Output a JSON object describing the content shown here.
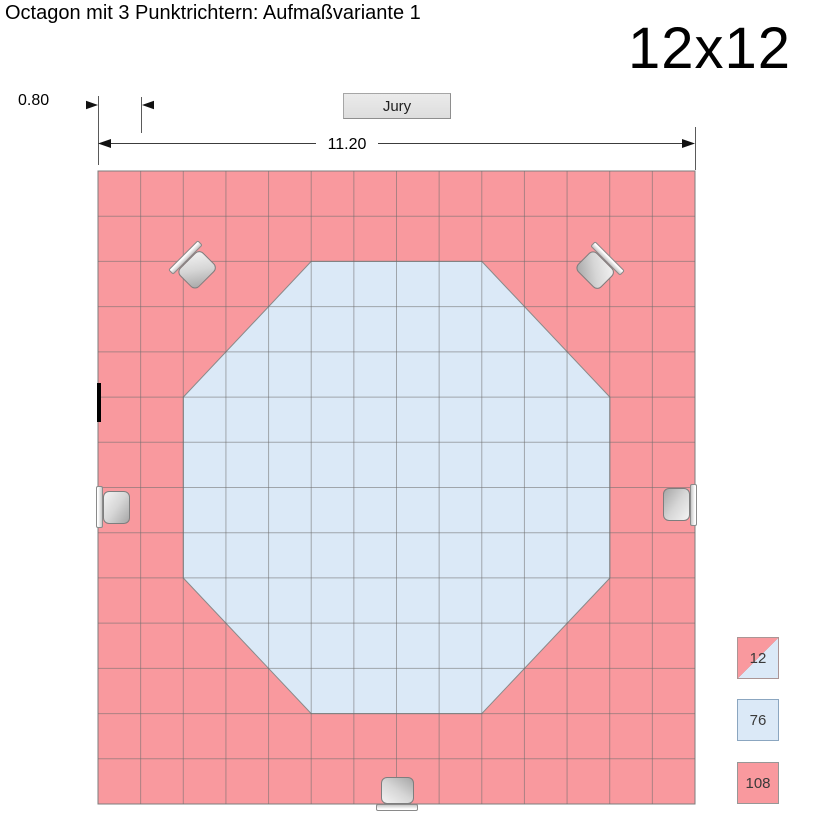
{
  "header": {
    "title": "Octagon mit 3 Punktrichtern: Aufmaßvariante 1",
    "size_label": "12x12"
  },
  "jury": {
    "label": "Jury"
  },
  "dimensions": {
    "cell_width": "0.80",
    "arena_width": "11.20"
  },
  "grid": {
    "cols": 14,
    "rows": 14
  },
  "colors": {
    "outer_area": "#F9999E",
    "inner_area": "#DBE9F7",
    "grid_line": "#6e6e6e",
    "outline": "#7d7d7d"
  },
  "legend": {
    "items": [
      {
        "value": "12",
        "kind": "split-cell"
      },
      {
        "value": "76",
        "kind": "inner-cell"
      },
      {
        "value": "108",
        "kind": "outer-cell"
      }
    ]
  },
  "markers": {
    "icons": [
      "judge-left",
      "judge-right",
      "judge-bottom",
      "marker-top-left",
      "marker-top-right"
    ]
  }
}
